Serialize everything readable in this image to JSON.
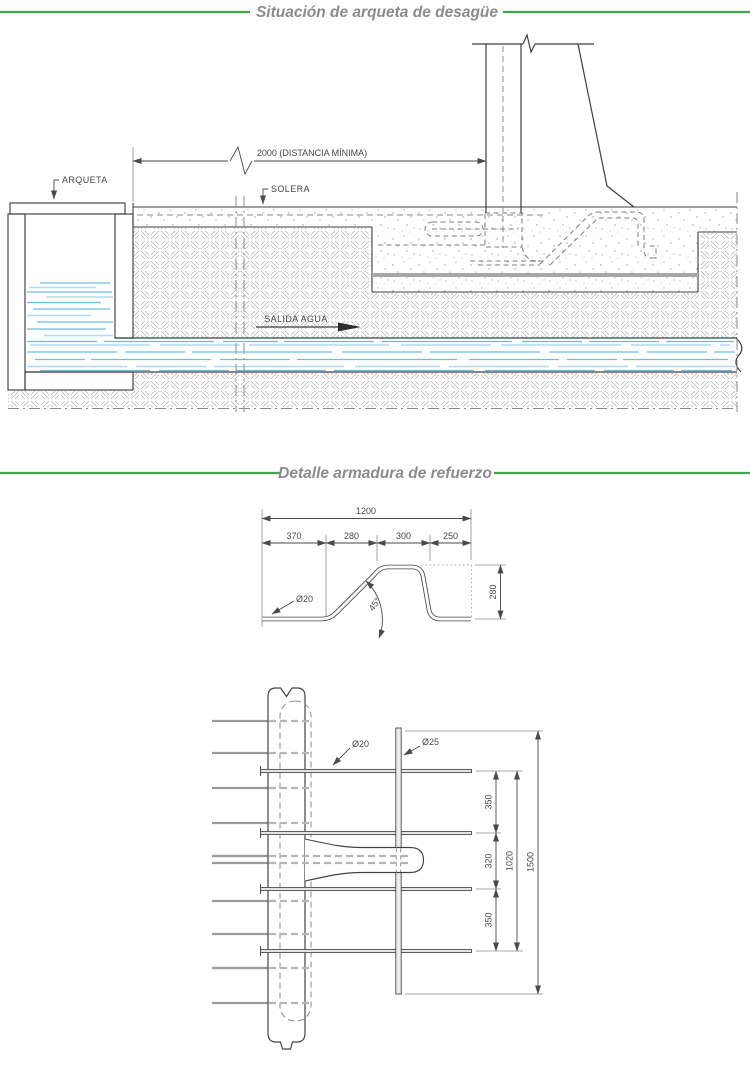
{
  "titles": {
    "section1": "Situación de arqueta de desagüe",
    "section2": "Detalle armadura de refuerzo"
  },
  "colors": {
    "accent_green": "#46a34b",
    "water_blue": "#6fbce2",
    "drawing_line": "#3f3f3f",
    "title_gray": "#8b8b8b"
  },
  "diagram1": {
    "labels": {
      "arqueta": "ARQUETA",
      "solera": "SOLERA",
      "salida_agua": "SALIDA AGUA",
      "distancia_minima": "2000 (DISTANCIA MÍNIMA)"
    }
  },
  "diagram2": {
    "bar_detail": {
      "dim_total": "1200",
      "dim_segments": [
        "370",
        "280",
        "300",
        "250"
      ],
      "dim_height": "280",
      "diameter_label": "Ø20",
      "angle_label": "45°"
    },
    "plan_detail": {
      "diameter_20": "Ø20",
      "diameter_25": "Ø25",
      "dim_spacing_top": "350",
      "dim_spacing_mid": "320",
      "dim_spacing_bottom": "350",
      "dim_inner": "1020",
      "dim_total": "1500"
    }
  }
}
